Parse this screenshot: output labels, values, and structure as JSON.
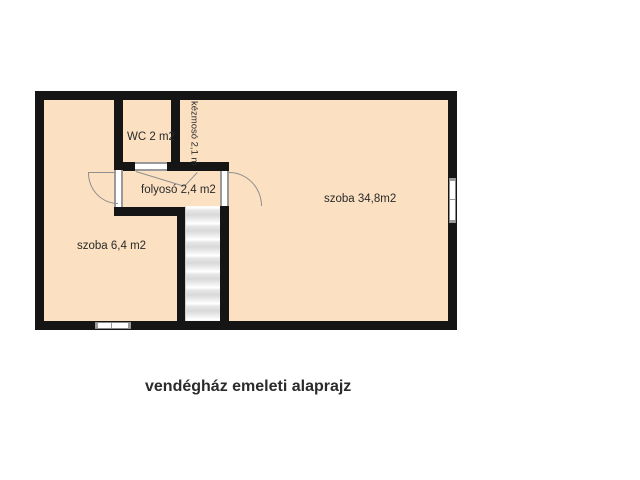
{
  "floorplan": {
    "caption": "vendégház emeleti alaprajz",
    "colors": {
      "wall": "#151515",
      "room_fill": "#fce0c2",
      "line": "#8a8a8a",
      "text": "#2a2a2a"
    },
    "rooms": [
      {
        "id": "wc",
        "label": "WC 2 m2"
      },
      {
        "id": "kezmoso",
        "label": "kézmosó 2,1 m",
        "orientation": "vertical"
      },
      {
        "id": "folyoso",
        "label": "folyosó 2,4 m2"
      },
      {
        "id": "szoba-nagy",
        "label": "szoba 34,8m2"
      },
      {
        "id": "szoba-kis",
        "label": "szoba 6,4 m2"
      }
    ],
    "features": [
      "staircase",
      "door-swing-left-room",
      "door-swing-big-room",
      "wc-door-leaf",
      "window-bottom-wall",
      "window-right-wall"
    ]
  }
}
